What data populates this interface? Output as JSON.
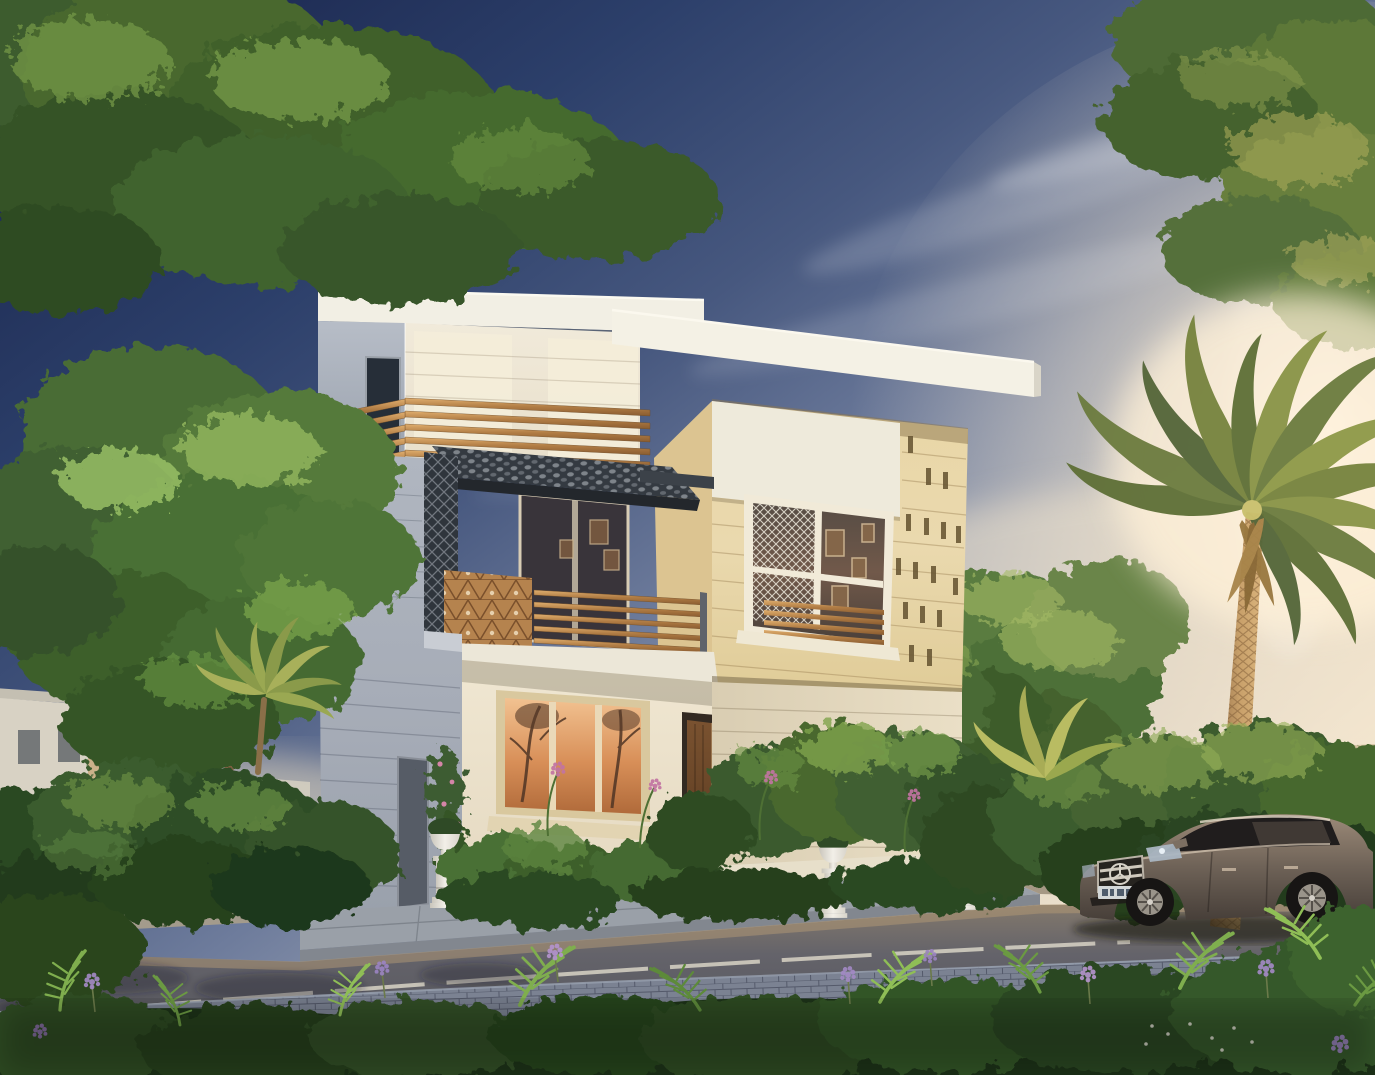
{
  "scene": {
    "title": "Modern villa exterior - dusk architectural rendering",
    "description": "Photorealistic rendering of a modern three-storey villa with cream and sandstone facades, wooden slat railings, dark perforated metal canopy, decorative lattice screens, landscaped beds with urn planters, a street with a parked bronze sedan and a silver coupe, tall palm tree and overhanging trees under a deep blue dusk sky with warm sun glow.",
    "time_of_day": "dusk",
    "weather": "clear with thin cirrus clouds"
  },
  "palette": {
    "sky_top": "#1f2d55",
    "sky_mid": "#6e7c9c",
    "sky_horizon": "#f6ead6",
    "sun_glow": "#fff3dc",
    "wall_lit": "#efe6d2",
    "wall_shaded": "#a9b0ba",
    "stone_beige": "#e6d3a4",
    "wood_slat": "#b98a55",
    "lattice_dark": "#343a41",
    "window_reflection": "#d88f58",
    "foliage_dark": "#2c4824",
    "foliage_mid": "#4a6c34",
    "foliage_highlight": "#8fb45c",
    "palm_trunk": "#c8a06a",
    "road_asphalt": "#5f5e62",
    "median_paver": "#7b8292",
    "sidewalk": "#9aa0a8",
    "car_bronze": "#6e6257",
    "car_silver": "#9aa3aa",
    "urn_white": "#e9e6df",
    "flower_purple": "#a289c4",
    "flower_pink": "#d585a8"
  },
  "objects": {
    "sky": "dusk gradient sky with cirrus wisps and sun glow",
    "main_villa": "three-storey modern villa, cream render with sandstone feature block",
    "tower": "white tower volume with roof slab and recessed panels",
    "terrace_railing": "horizontal wooden slat railing on roof terrace",
    "canopy": "dark perforated metal balcony canopy",
    "balcony": "first-floor balcony with wood screen boxes and slat railing",
    "stone_block": "sandstone-clad volume with slot ornaments and lattice window",
    "ground_floor": "cream ground floor with glowing window, timber door and steps",
    "planters": "four classical white urn planters",
    "left_tree": "tall backlit tree on the left",
    "overhanging_canopies": "tree branches overhanging top-left and top-right corners",
    "palm_tree": "tall date palm backlit by the sun",
    "neighbor_villas": "background villas with wooden balcony slats",
    "left_car": "silver coupe parked behind the hedge",
    "right_car": "bronze Mercedes sedan parked at the kerb",
    "road": "asphalt road with white lane line",
    "median": "blue-grey paver median strip",
    "foreground": "ferns, groundcover and purple flower clusters"
  }
}
